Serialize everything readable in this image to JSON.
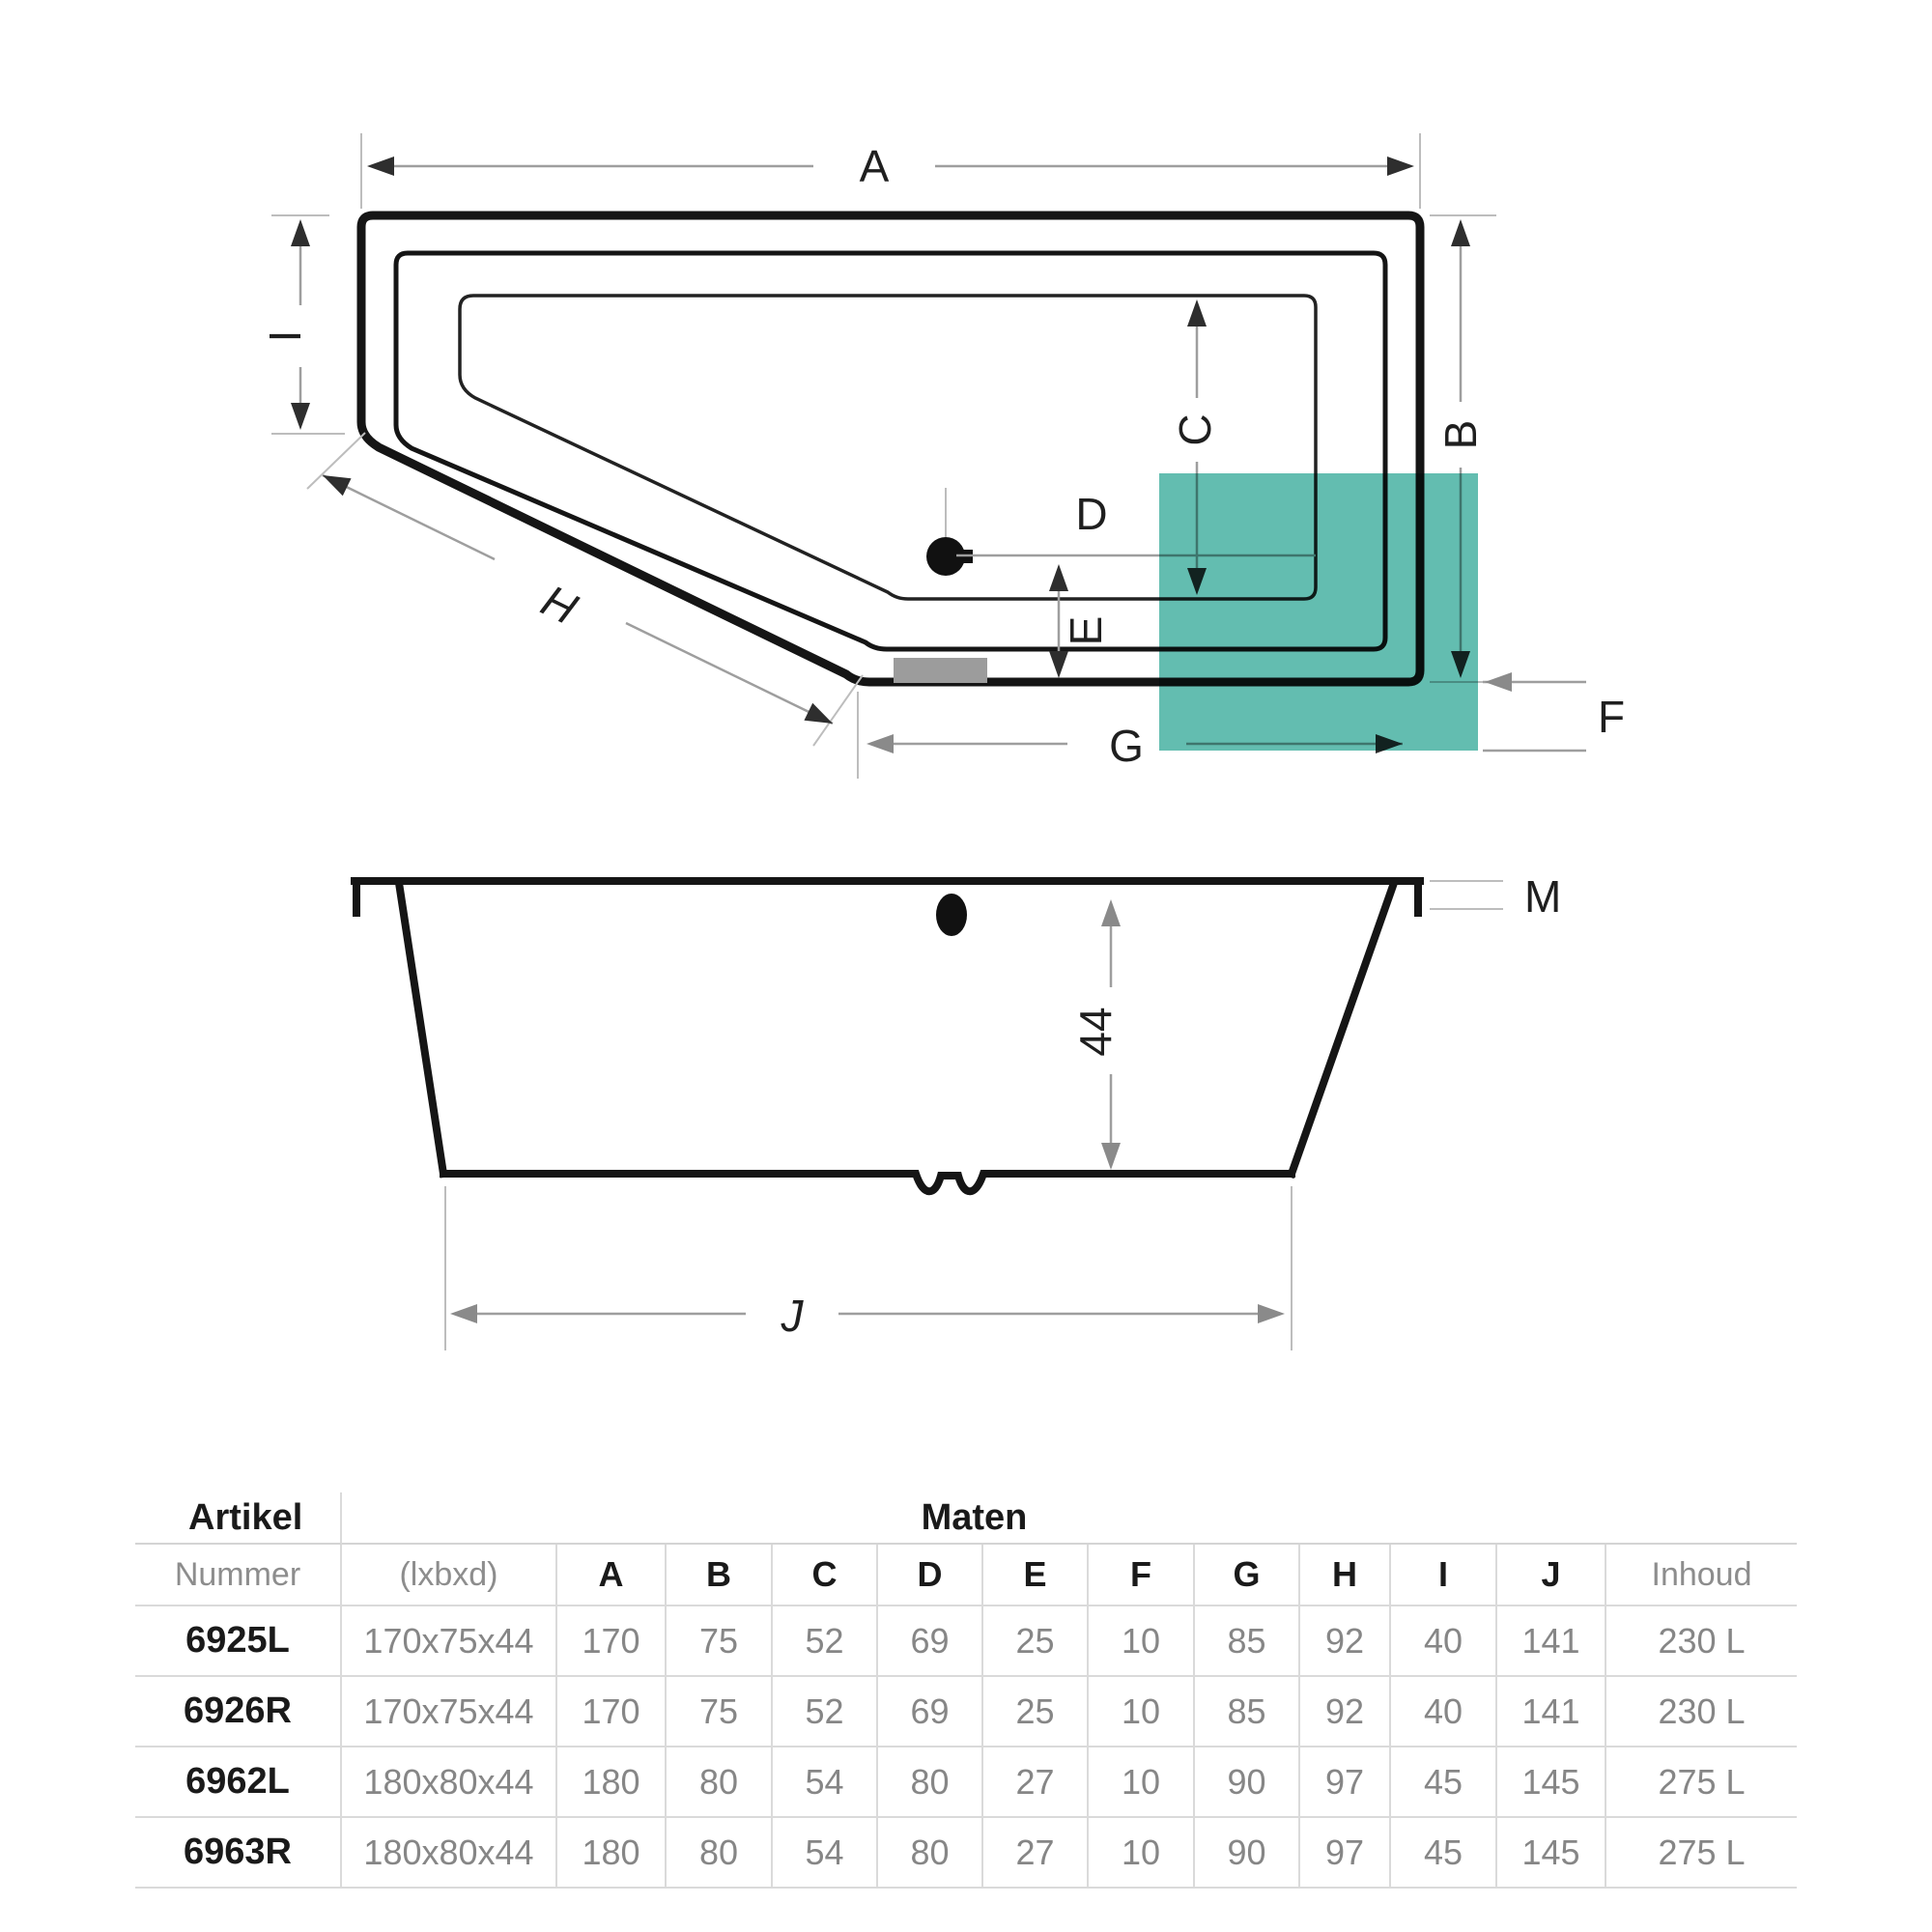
{
  "diagram": {
    "labels": {
      "a": "A",
      "b": "B",
      "c": "C",
      "d": "D",
      "e": "E",
      "f": "F",
      "g": "G",
      "h": "H",
      "i": "I",
      "j": "J",
      "m": "M",
      "depth": "44"
    },
    "colors": {
      "teal_square": "#63bdb0",
      "main_line": "#151515",
      "dim_line": "#9e9e9e",
      "overflow_pad": "#9c9c9c"
    }
  },
  "table": {
    "title_left": "Artikel",
    "title_right": "Maten",
    "col_number_header": "Nummer",
    "col_size_header": "(lxbxd)",
    "value_headers": [
      "A",
      "B",
      "C",
      "D",
      "E",
      "F",
      "G",
      "H",
      "I",
      "J"
    ],
    "col_volume_header": "Inhoud",
    "rows": [
      {
        "nummer": "6925L",
        "size": "170x75x44",
        "values": [
          "170",
          "75",
          "52",
          "69",
          "25",
          "10",
          "85",
          "92",
          "40",
          "141"
        ],
        "inhoud": "230 L"
      },
      {
        "nummer": "6926R",
        "size": "170x75x44",
        "values": [
          "170",
          "75",
          "52",
          "69",
          "25",
          "10",
          "85",
          "92",
          "40",
          "141"
        ],
        "inhoud": "230 L"
      },
      {
        "nummer": "6962L",
        "size": "180x80x44",
        "values": [
          "180",
          "80",
          "54",
          "80",
          "27",
          "10",
          "90",
          "97",
          "45",
          "145"
        ],
        "inhoud": "275 L"
      },
      {
        "nummer": "6963R",
        "size": "180x80x44",
        "values": [
          "180",
          "80",
          "54",
          "80",
          "27",
          "10",
          "90",
          "97",
          "45",
          "145"
        ],
        "inhoud": "275 L"
      }
    ]
  }
}
